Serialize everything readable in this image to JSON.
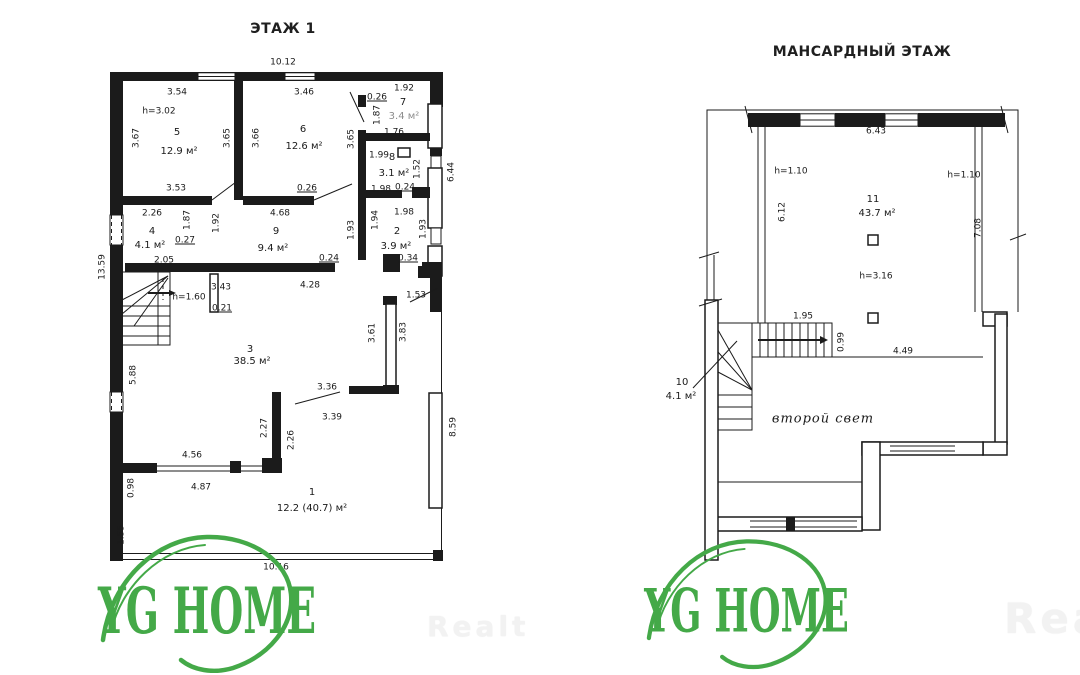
{
  "colors": {
    "wall": "#1b1b1b",
    "logo_green": "#44a948",
    "dim_text": "#1a1a1a",
    "watermark": "#f2f2f2",
    "faded_text": "#8d8d8d"
  },
  "floor1": {
    "title": "ЭТАЖ 1",
    "labels": [
      {
        "t": "10.12",
        "x": 283,
        "y": 63
      },
      {
        "t": "3.54",
        "x": 177,
        "y": 93
      },
      {
        "t": "3.46",
        "x": 304,
        "y": 93
      },
      {
        "t": "0.26",
        "x": 377,
        "y": 98,
        "u": 1
      },
      {
        "t": "1.92",
        "x": 404,
        "y": 89
      },
      {
        "t": "1.87",
        "x": 378,
        "y": 115,
        "r": 1
      },
      {
        "t": "1.76",
        "x": 394,
        "y": 133
      },
      {
        "t": "h=3.02",
        "x": 159,
        "y": 112
      },
      {
        "t": "3.67",
        "x": 137,
        "y": 138,
        "r": 1
      },
      {
        "t": "3.65",
        "x": 228,
        "y": 138,
        "r": 1
      },
      {
        "t": "3.66",
        "x": 257,
        "y": 138,
        "r": 1
      },
      {
        "t": "3.65",
        "x": 352,
        "y": 139,
        "r": 1
      },
      {
        "t": "1.99",
        "x": 379,
        "y": 156
      },
      {
        "t": "1.52",
        "x": 418,
        "y": 169,
        "r": 1
      },
      {
        "t": "6.44",
        "x": 452,
        "y": 172,
        "r": 1
      },
      {
        "t": "1.98",
        "x": 381,
        "y": 190
      },
      {
        "t": "0.24",
        "x": 405,
        "y": 188,
        "u": 1
      },
      {
        "t": "3.53",
        "x": 176,
        "y": 189
      },
      {
        "t": "0.26",
        "x": 307,
        "y": 189,
        "u": 1
      },
      {
        "t": "4.68",
        "x": 280,
        "y": 214
      },
      {
        "t": "2.26",
        "x": 152,
        "y": 214
      },
      {
        "t": "1.87",
        "x": 188,
        "y": 220,
        "r": 1
      },
      {
        "t": "1.92",
        "x": 217,
        "y": 223,
        "r": 1
      },
      {
        "t": "0.27",
        "x": 185,
        "y": 241,
        "u": 1
      },
      {
        "t": "2.05",
        "x": 164,
        "y": 261
      },
      {
        "t": "1.93",
        "x": 352,
        "y": 230,
        "r": 1
      },
      {
        "t": "1.94",
        "x": 376,
        "y": 220,
        "r": 1
      },
      {
        "t": "1.98",
        "x": 404,
        "y": 213
      },
      {
        "t": "1.93",
        "x": 424,
        "y": 229,
        "r": 1
      },
      {
        "t": "0.24",
        "x": 329,
        "y": 259,
        "u": 1
      },
      {
        "t": "0.34",
        "x": 408,
        "y": 259,
        "u": 1
      },
      {
        "t": "4.28",
        "x": 310,
        "y": 286
      },
      {
        "t": "1.53",
        "x": 416,
        "y": 296
      },
      {
        "t": "13.59",
        "x": 103,
        "y": 267,
        "r": 1
      },
      {
        "t": "h=1.60",
        "x": 189,
        "y": 298
      },
      {
        "t": "3.43",
        "x": 221,
        "y": 288
      },
      {
        "t": "0.21",
        "x": 222,
        "y": 309,
        "u": 1
      },
      {
        "t": "3.61",
        "x": 373,
        "y": 333,
        "r": 1
      },
      {
        "t": "3.83",
        "x": 404,
        "y": 332,
        "r": 1
      },
      {
        "t": "5.88",
        "x": 134,
        "y": 375,
        "r": 1
      },
      {
        "t": "3.36",
        "x": 327,
        "y": 388
      },
      {
        "t": "3.39",
        "x": 332,
        "y": 418
      },
      {
        "t": "2.27",
        "x": 265,
        "y": 428,
        "r": 1
      },
      {
        "t": "2.26",
        "x": 292,
        "y": 440,
        "r": 1
      },
      {
        "t": "8.59",
        "x": 454,
        "y": 427,
        "r": 1
      },
      {
        "t": "4.56",
        "x": 192,
        "y": 456
      },
      {
        "t": "4.87",
        "x": 201,
        "y": 488
      },
      {
        "t": "0.98",
        "x": 132,
        "y": 488,
        "r": 1
      },
      {
        "t": "1.55",
        "x": 122,
        "y": 535,
        "r": 1
      },
      {
        "t": "10.16",
        "x": 276,
        "y": 568
      },
      {
        "t": "5",
        "x": 177,
        "y": 133,
        "n": "room-number",
        "fs": 10
      },
      {
        "t": "12.9 м²",
        "x": 179,
        "y": 152,
        "n": "room-area",
        "fs": 10
      },
      {
        "t": "6",
        "x": 303,
        "y": 130,
        "n": "room-number",
        "fs": 10
      },
      {
        "t": "12.6 м²",
        "x": 304,
        "y": 147,
        "n": "room-area",
        "fs": 10
      },
      {
        "t": "7",
        "x": 403,
        "y": 103,
        "n": "room-number",
        "fs": 10
      },
      {
        "t": "3.4 м²",
        "x": 404,
        "y": 117,
        "n": "room-area",
        "fs": 10,
        "f": 1
      },
      {
        "t": "8",
        "x": 392,
        "y": 158,
        "n": "room-number",
        "fs": 10
      },
      {
        "t": "3.1 м²",
        "x": 394,
        "y": 174,
        "n": "room-area",
        "fs": 10
      },
      {
        "t": "4",
        "x": 152,
        "y": 232,
        "n": "room-number",
        "fs": 10
      },
      {
        "t": "4.1 м²",
        "x": 150,
        "y": 246,
        "n": "room-area",
        "fs": 10
      },
      {
        "t": "2",
        "x": 397,
        "y": 232,
        "n": "room-number",
        "fs": 10
      },
      {
        "t": "3.9 м²",
        "x": 396,
        "y": 247,
        "n": "room-area",
        "fs": 10
      },
      {
        "t": "9",
        "x": 276,
        "y": 232,
        "n": "room-number",
        "fs": 10
      },
      {
        "t": "9.4 м²",
        "x": 273,
        "y": 249,
        "n": "room-area",
        "fs": 10
      },
      {
        "t": "3",
        "x": 250,
        "y": 350,
        "n": "room-number",
        "fs": 10
      },
      {
        "t": "38.5 м²",
        "x": 252,
        "y": 362,
        "n": "room-area",
        "fs": 10
      },
      {
        "t": "1",
        "x": 312,
        "y": 493,
        "n": "room-number",
        "fs": 10
      },
      {
        "t": "12.2 (40.7) м²",
        "x": 312,
        "y": 509,
        "n": "room-area",
        "fs": 10
      }
    ]
  },
  "floor2": {
    "title": "МАНСАРДНЫЙ ЭТАЖ",
    "labels": [
      {
        "t": "6.43",
        "x": 876,
        "y": 132
      },
      {
        "t": "h=1.10",
        "x": 791,
        "y": 172
      },
      {
        "t": "h=1.10",
        "x": 964,
        "y": 176
      },
      {
        "t": "6.12",
        "x": 783,
        "y": 212,
        "r": 1
      },
      {
        "t": "7.08",
        "x": 979,
        "y": 228,
        "r": 1
      },
      {
        "t": "h=3.16",
        "x": 876,
        "y": 277
      },
      {
        "t": "1.95",
        "x": 803,
        "y": 317
      },
      {
        "t": "0.99",
        "x": 842,
        "y": 342,
        "r": 1
      },
      {
        "t": "4.49",
        "x": 903,
        "y": 352
      },
      {
        "t": "11",
        "x": 873,
        "y": 200,
        "n": "room-number",
        "fs": 10
      },
      {
        "t": "43.7 м²",
        "x": 877,
        "y": 214,
        "n": "room-area",
        "fs": 10
      },
      {
        "t": "10",
        "x": 682,
        "y": 383,
        "n": "room-number",
        "fs": 10
      },
      {
        "t": "4.1 м²",
        "x": 681,
        "y": 397,
        "n": "room-area",
        "fs": 10
      },
      {
        "t": "второй свет",
        "x": 823,
        "y": 419,
        "n": "second-light-label",
        "cls": "script"
      }
    ]
  },
  "logos": [
    {
      "text": "YG HOME"
    },
    {
      "text": "YG HOME"
    }
  ],
  "watermarks": [
    {
      "text": "Realt"
    },
    {
      "text": "Realt"
    }
  ]
}
